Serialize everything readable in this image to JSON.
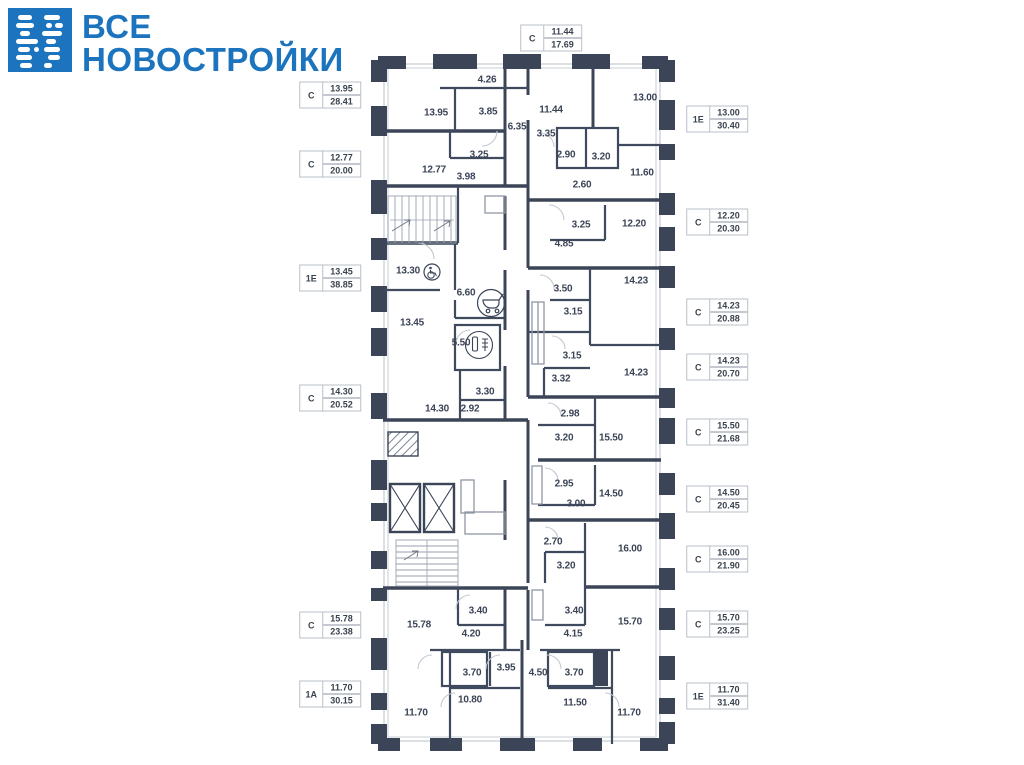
{
  "brand": {
    "line1": "ВСЕ",
    "line2": "НОВОСТРОЙКИ",
    "color": "#1b74bd"
  },
  "colors": {
    "brand_blue": "#1b74bd",
    "wall": "#3b4557",
    "window_line": "#d3d7dc",
    "text": "#39434f",
    "label_border": "#b9bfc9"
  },
  "floor_plan": {
    "room_areas": [
      {
        "v": "4.26",
        "x": 487,
        "y": 80
      },
      {
        "v": "13.95",
        "x": 436,
        "y": 113
      },
      {
        "v": "3.85",
        "x": 488,
        "y": 112
      },
      {
        "v": "6.35",
        "x": 517,
        "y": 127
      },
      {
        "v": "3.25",
        "x": 479,
        "y": 155
      },
      {
        "v": "12.77",
        "x": 434,
        "y": 170
      },
      {
        "v": "3.98",
        "x": 466,
        "y": 177
      },
      {
        "v": "11.44",
        "x": 551,
        "y": 110
      },
      {
        "v": "13.00",
        "x": 645,
        "y": 98
      },
      {
        "v": "3.35",
        "x": 546,
        "y": 134
      },
      {
        "v": "2.90",
        "x": 566,
        "y": 155
      },
      {
        "v": "3.20",
        "x": 601,
        "y": 157
      },
      {
        "v": "11.60",
        "x": 642,
        "y": 173
      },
      {
        "v": "2.60",
        "x": 582,
        "y": 185
      },
      {
        "v": "3.25",
        "x": 581,
        "y": 225
      },
      {
        "v": "12.20",
        "x": 634,
        "y": 224
      },
      {
        "v": "4.85",
        "x": 564,
        "y": 244
      },
      {
        "v": "13.30",
        "x": 408,
        "y": 271
      },
      {
        "v": "6.60",
        "x": 466,
        "y": 293
      },
      {
        "v": "3.50",
        "x": 563,
        "y": 289
      },
      {
        "v": "14.23",
        "x": 636,
        "y": 281
      },
      {
        "v": "3.15",
        "x": 573,
        "y": 312
      },
      {
        "v": "13.45",
        "x": 412,
        "y": 323
      },
      {
        "v": "5.50",
        "x": 461,
        "y": 343
      },
      {
        "v": "3.15",
        "x": 572,
        "y": 356
      },
      {
        "v": "3.32",
        "x": 561,
        "y": 379
      },
      {
        "v": "14.23",
        "x": 636,
        "y": 373
      },
      {
        "v": "3.30",
        "x": 485,
        "y": 392
      },
      {
        "v": "14.30",
        "x": 437,
        "y": 409
      },
      {
        "v": "2.92",
        "x": 470,
        "y": 409
      },
      {
        "v": "2.98",
        "x": 570,
        "y": 414
      },
      {
        "v": "3.20",
        "x": 564,
        "y": 438
      },
      {
        "v": "15.50",
        "x": 611,
        "y": 438
      },
      {
        "v": "2.95",
        "x": 564,
        "y": 484
      },
      {
        "v": "14.50",
        "x": 611,
        "y": 494
      },
      {
        "v": "3.00",
        "x": 576,
        "y": 504
      },
      {
        "v": "2.70",
        "x": 553,
        "y": 542
      },
      {
        "v": "16.00",
        "x": 630,
        "y": 549
      },
      {
        "v": "3.20",
        "x": 566,
        "y": 566
      },
      {
        "v": "3.40",
        "x": 478,
        "y": 611
      },
      {
        "v": "3.40",
        "x": 574,
        "y": 611
      },
      {
        "v": "15.78",
        "x": 419,
        "y": 625
      },
      {
        "v": "15.70",
        "x": 630,
        "y": 622
      },
      {
        "v": "4.20",
        "x": 471,
        "y": 634
      },
      {
        "v": "4.15",
        "x": 573,
        "y": 634
      },
      {
        "v": "3.70",
        "x": 472,
        "y": 673
      },
      {
        "v": "3.95",
        "x": 506,
        "y": 668
      },
      {
        "v": "4.50",
        "x": 538,
        "y": 673
      },
      {
        "v": "3.70",
        "x": 574,
        "y": 673
      },
      {
        "v": "10.80",
        "x": 470,
        "y": 700
      },
      {
        "v": "11.50",
        "x": 575,
        "y": 703
      },
      {
        "v": "11.70",
        "x": 416,
        "y": 713
      },
      {
        "v": "11.70",
        "x": 629,
        "y": 713
      }
    ],
    "icons": [
      {
        "name": "wheelchair-icon",
        "x": 432,
        "y": 272
      },
      {
        "name": "stroller-icon",
        "x": 491,
        "y": 303
      },
      {
        "name": "bathroom-icon",
        "x": 479,
        "y": 345
      }
    ]
  },
  "apartment_labels": [
    {
      "type": "С",
      "area_living": "11.44",
      "area_total": "17.69",
      "x": 551,
      "y": 38
    },
    {
      "type": "С",
      "area_living": "13.95",
      "area_total": "28.41",
      "x": 330,
      "y": 95
    },
    {
      "type": "С",
      "area_living": "12.77",
      "area_total": "20.00",
      "x": 330,
      "y": 164
    },
    {
      "type": "1Е",
      "area_living": "13.45",
      "area_total": "38.85",
      "x": 330,
      "y": 278
    },
    {
      "type": "С",
      "area_living": "14.30",
      "area_total": "20.52",
      "x": 330,
      "y": 398
    },
    {
      "type": "С",
      "area_living": "15.78",
      "area_total": "23.38",
      "x": 330,
      "y": 625
    },
    {
      "type": "1А",
      "area_living": "11.70",
      "area_total": "30.15",
      "x": 330,
      "y": 694
    },
    {
      "type": "1Е",
      "area_living": "13.00",
      "area_total": "30.40",
      "x": 717,
      "y": 119
    },
    {
      "type": "С",
      "area_living": "12.20",
      "area_total": "20.30",
      "x": 717,
      "y": 222
    },
    {
      "type": "С",
      "area_living": "14.23",
      "area_total": "20.88",
      "x": 717,
      "y": 312
    },
    {
      "type": "С",
      "area_living": "14.23",
      "area_total": "20.70",
      "x": 717,
      "y": 367
    },
    {
      "type": "С",
      "area_living": "15.50",
      "area_total": "21.68",
      "x": 717,
      "y": 432
    },
    {
      "type": "С",
      "area_living": "14.50",
      "area_total": "20.45",
      "x": 717,
      "y": 499
    },
    {
      "type": "С",
      "area_living": "16.00",
      "area_total": "21.90",
      "x": 717,
      "y": 559
    },
    {
      "type": "С",
      "area_living": "15.70",
      "area_total": "23.25",
      "x": 717,
      "y": 624
    },
    {
      "type": "1Е",
      "area_living": "11.70",
      "area_total": "31.40",
      "x": 717,
      "y": 696
    }
  ]
}
